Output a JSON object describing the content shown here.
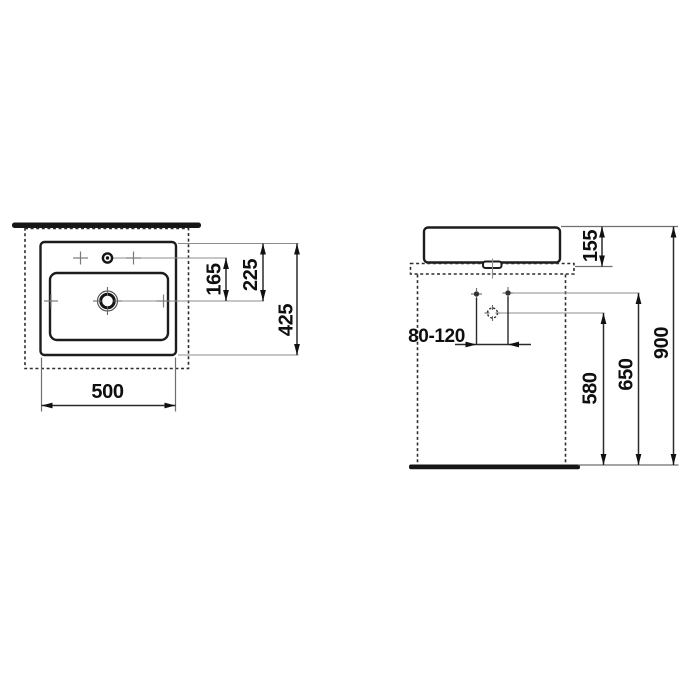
{
  "colors": {
    "line": "#1c1c1c",
    "thin_line": "#8c8c8c",
    "dimension": "#2a2a2a",
    "text": "#0f0f0f",
    "background": "#ffffff"
  },
  "top_view": {
    "dim_faucet_to_drain": "165",
    "dim_rim_to_drain": "225",
    "dim_depth": "425",
    "dim_width": "500"
  },
  "front_view": {
    "dim_basin_height": "155",
    "dim_connection_range": "80-120",
    "dim_drain_height": "580",
    "dim_connection_height": "650",
    "dim_rim_height": "900"
  }
}
